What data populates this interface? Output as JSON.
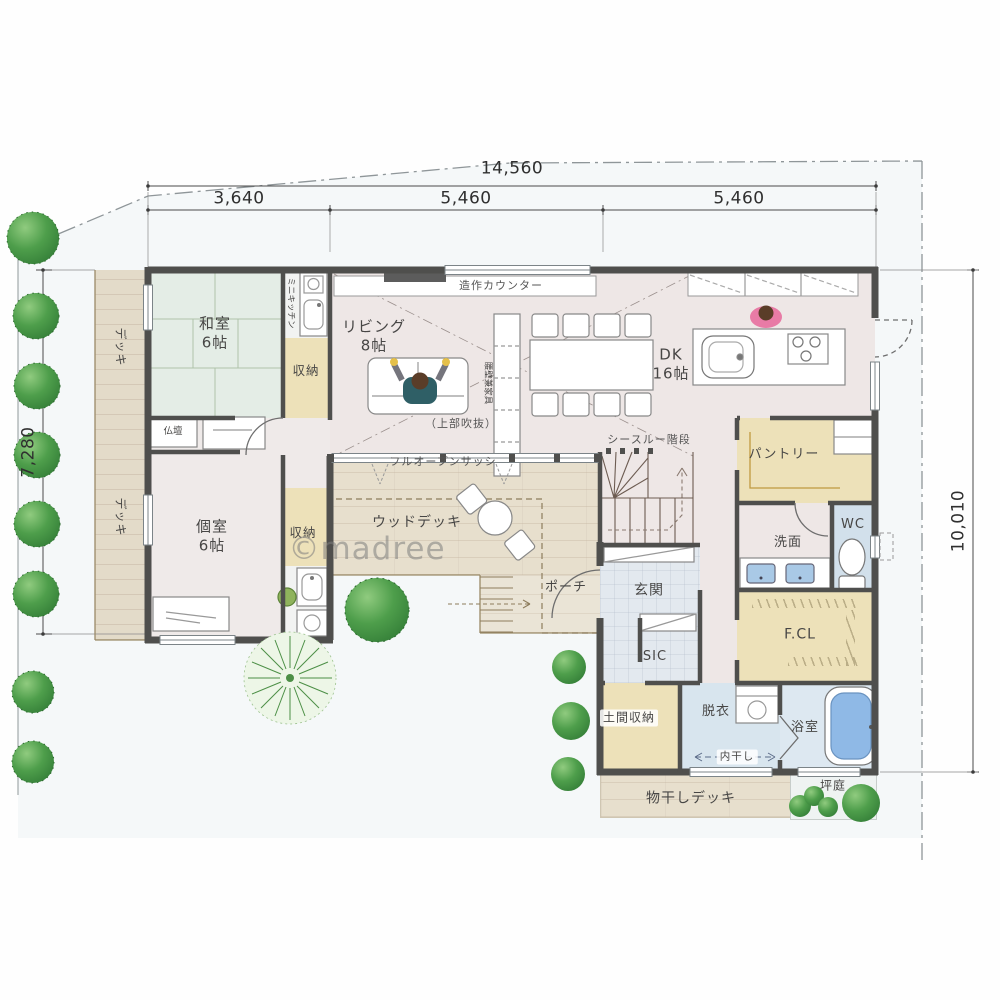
{
  "dims": {
    "total": "14,560",
    "segs": [
      "3,640",
      "5,460",
      "5,460"
    ],
    "left": "7,280",
    "right": "10,010"
  },
  "rooms": {
    "washitsu": {
      "name": "和室",
      "size": "6帖"
    },
    "living": {
      "name": "リビング",
      "size": "8帖"
    },
    "dk": {
      "name": "DK",
      "size": "16帖"
    },
    "koshitsu": {
      "name": "個室",
      "size": "6帖"
    },
    "closet_north": {
      "name": "収納"
    },
    "closet_south": {
      "name": "収納"
    },
    "pantry": {
      "name": "パントリー"
    },
    "washroom": {
      "name": "洗面"
    },
    "wc": {
      "name": "WC"
    },
    "family_closet": {
      "name": "F.CL"
    },
    "genkan": {
      "name": "玄関"
    },
    "sic": {
      "name": "SIC"
    },
    "doma_storage": {
      "name": "土間収納"
    },
    "datsui": {
      "name": "脱衣"
    },
    "bathroom": {
      "name": "浴室"
    },
    "wood_deck": {
      "name": "ウッドデッキ"
    },
    "deck_north": {
      "name": "デッキ"
    },
    "deck_south": {
      "name": "デッキ"
    },
    "porch": {
      "name": "ポーチ"
    },
    "laundry_deck": {
      "name": "物干しデッキ"
    },
    "tsubo_garden": {
      "name": "坪庭"
    }
  },
  "annotations": {
    "built_in_counter": "造作カウンター",
    "mini_kitchen": "ミニキッチン",
    "butsudan": "仏壇",
    "upper_void": "（上部吹抜）",
    "full_open_sash": "フルオープンサッシ",
    "see_through_stairs": "シースルー階段",
    "half_wall_furniture": "腰壁兼家具",
    "indoor_drying": "内干し"
  },
  "watermark": "©madree",
  "colors": {
    "wall": "#4f4f4d",
    "floor_pink": "#f1dedb",
    "tatami_green": "#dfe9da",
    "storage_yellow": "#eed489",
    "wet_blue": "#c9dbea",
    "wood_beige": "#e3cfae",
    "greenery": "#4e9e4b"
  }
}
